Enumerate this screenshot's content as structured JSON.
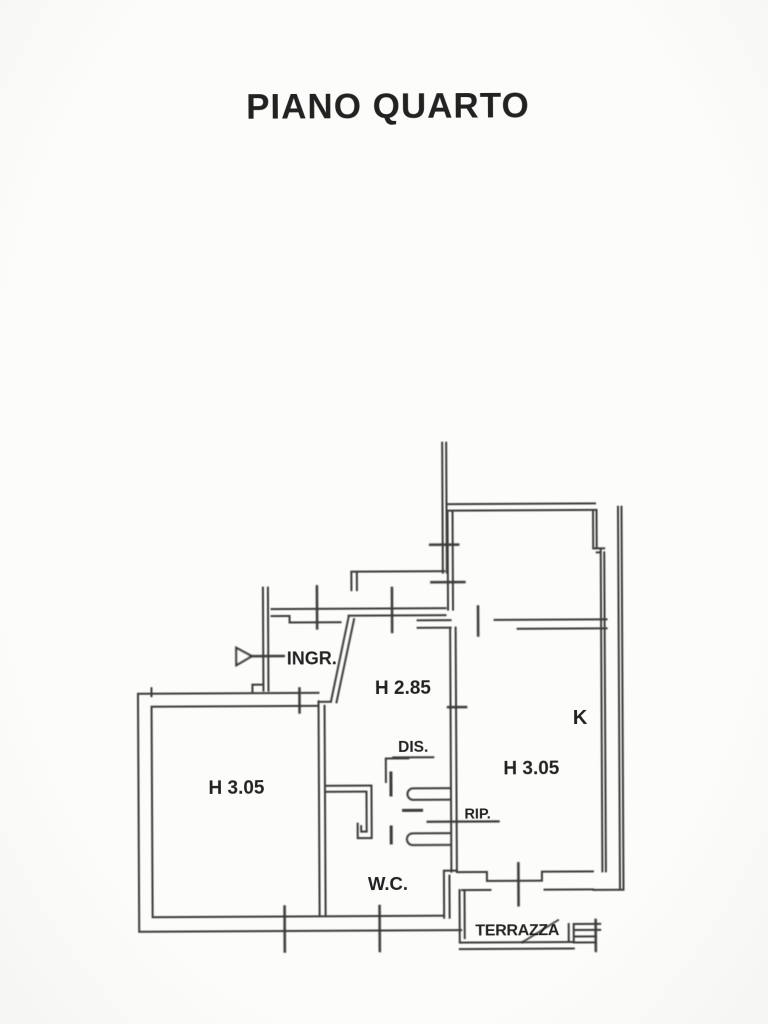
{
  "title": "PIANO QUARTO",
  "colors": {
    "paper": "#fcfcfa",
    "ink": "#3a3a3a",
    "text_ink": "#242424"
  },
  "plan": {
    "labels": {
      "entrance": "INGR.",
      "hall_height": "H 2.85",
      "closet": "DIS.",
      "storage": "RIP.",
      "bathroom": "W.C.",
      "kitchen": "K",
      "kitchen_height": "H 3.05",
      "left_room_height": "H 3.05",
      "terrace": "TERRAZZA"
    }
  }
}
